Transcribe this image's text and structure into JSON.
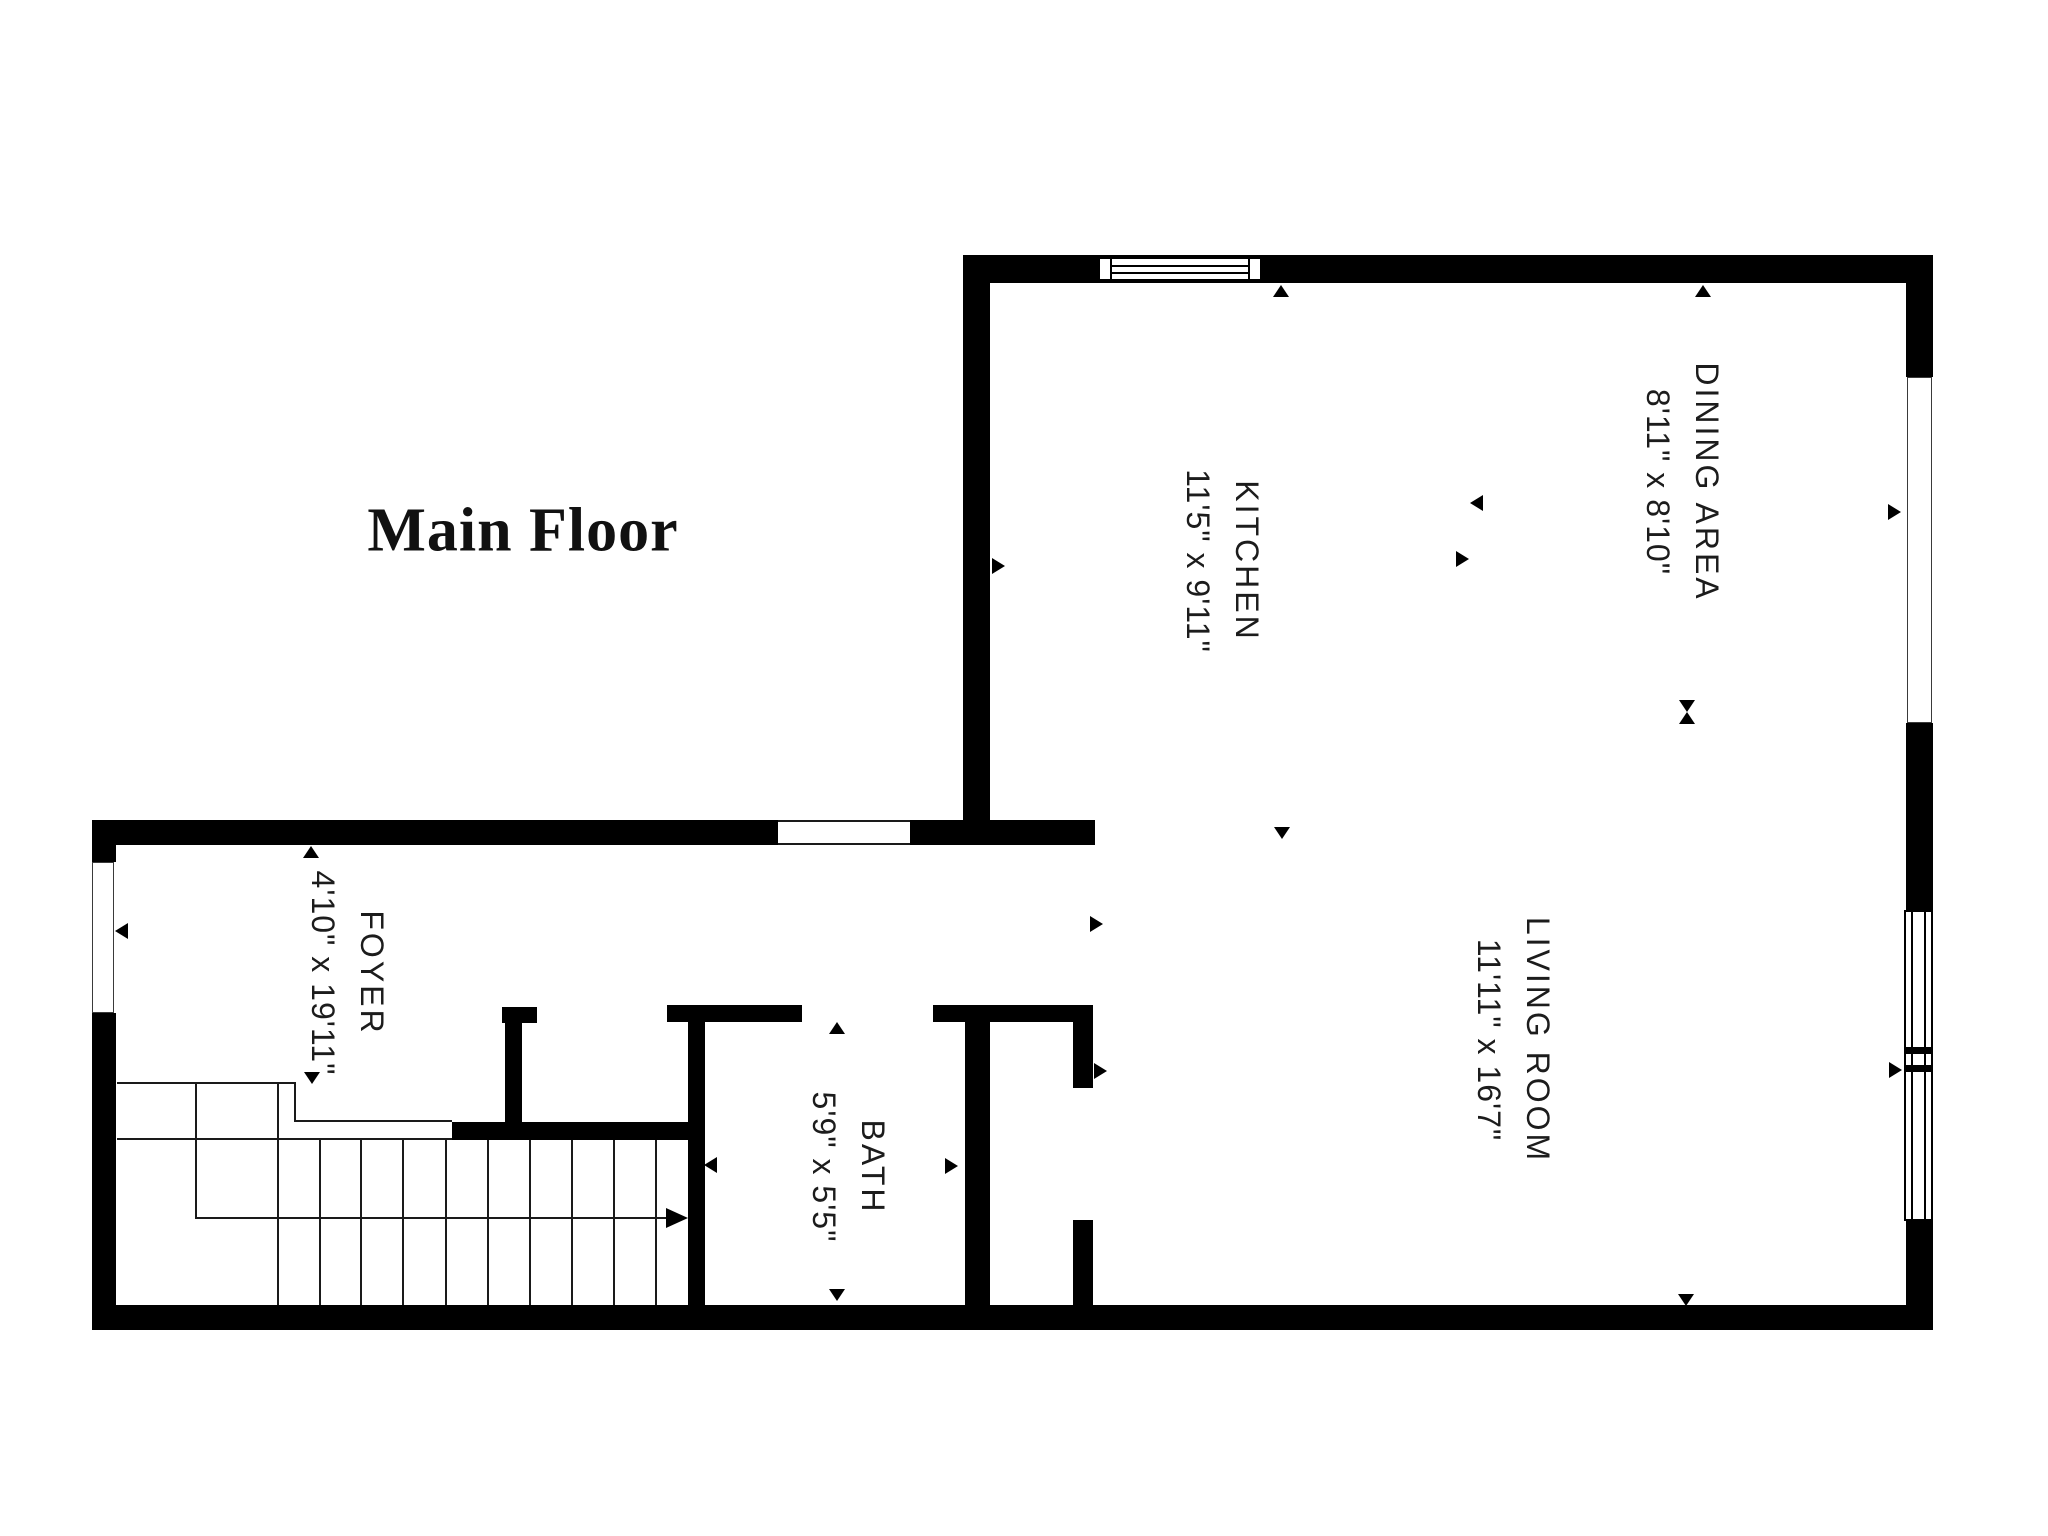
{
  "title": "Main Floor",
  "rooms": [
    {
      "id": "kitchen",
      "name": "KITCHEN",
      "dims": "11'5\" x 9'11\""
    },
    {
      "id": "dining-area",
      "name": "DINING AREA",
      "dims": "8'11\" x 8'10\""
    },
    {
      "id": "living-room",
      "name": "LIVING ROOM",
      "dims": "11'11\" x 16'7\""
    },
    {
      "id": "foyer",
      "name": "FOYER",
      "dims": "4'10\" x 19'11\""
    },
    {
      "id": "bath",
      "name": "BATH",
      "dims": "5'9\" x 5'5\""
    }
  ],
  "colors": {
    "wall": "#000000",
    "text": "#1c1c1c",
    "background": "#ffffff"
  }
}
